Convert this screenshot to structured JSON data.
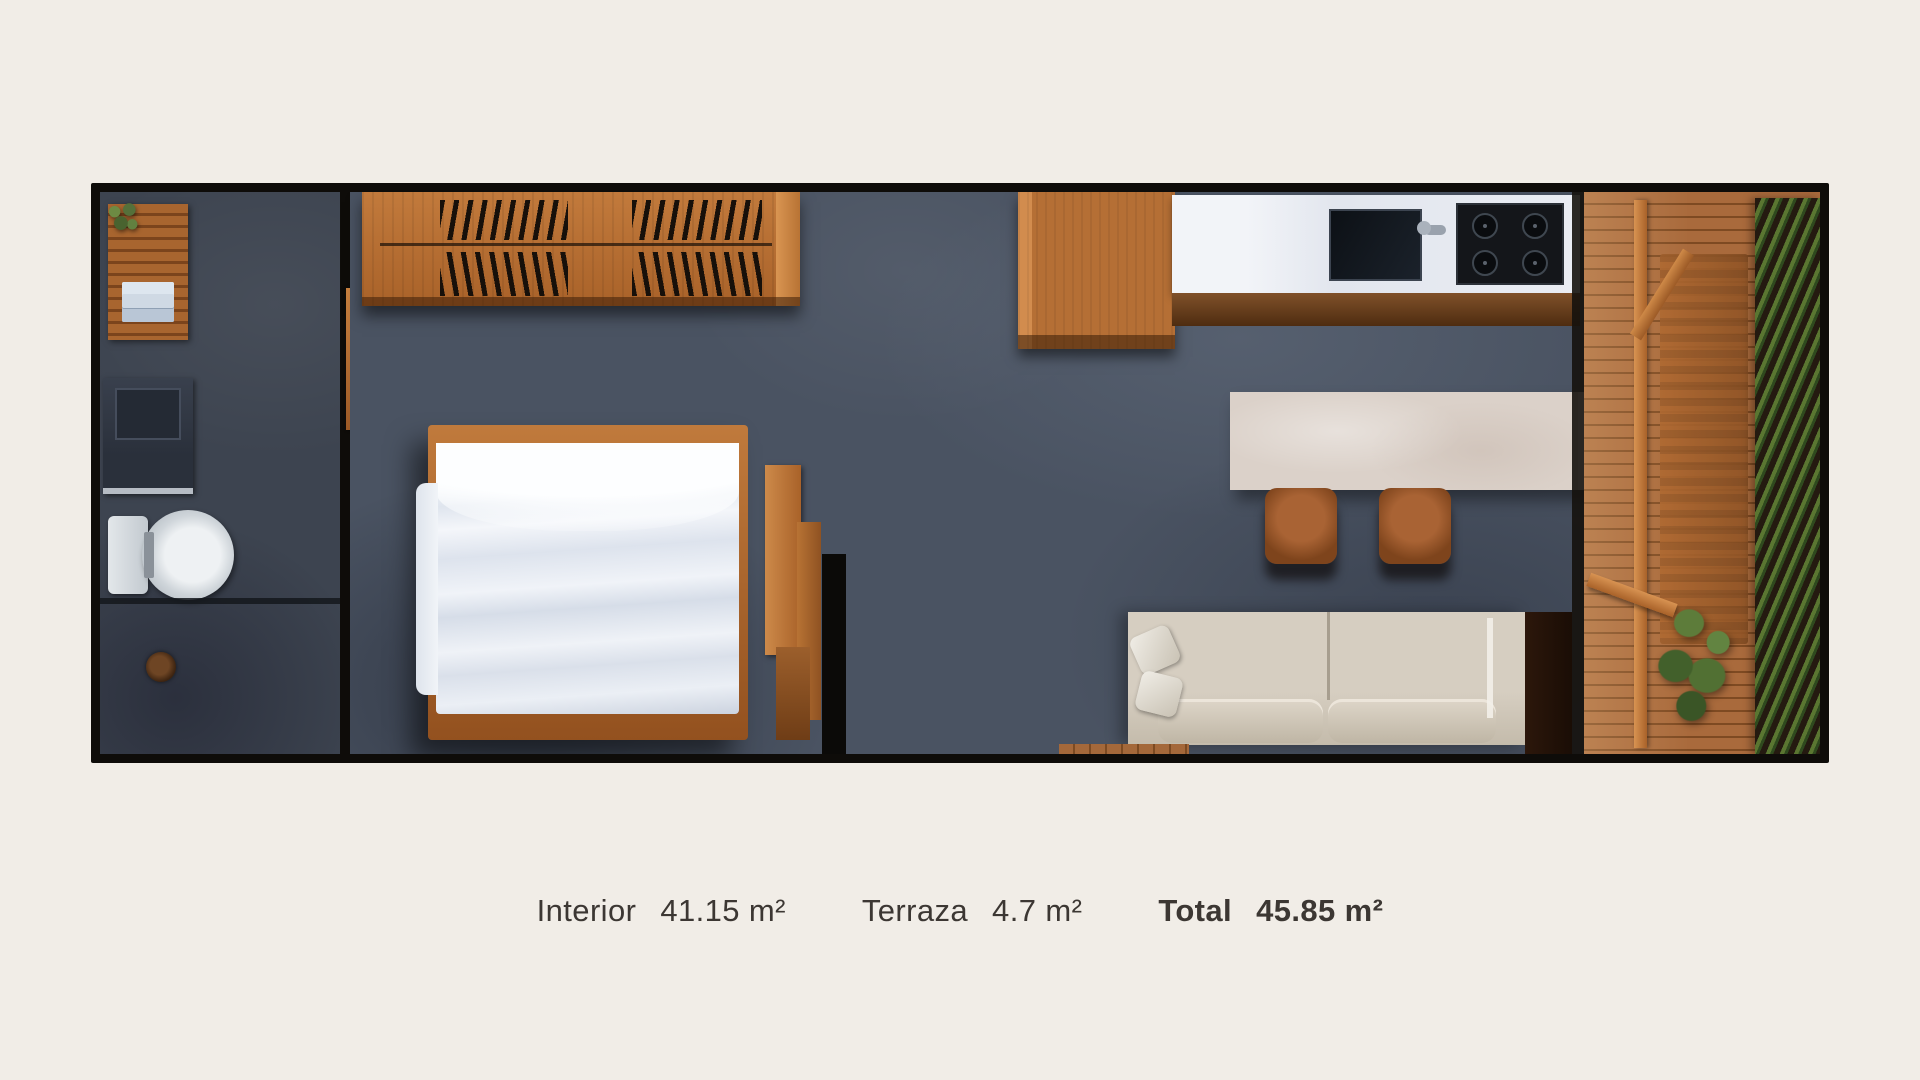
{
  "caption": {
    "items": [
      {
        "label": "Interior",
        "value": "41.15 m²",
        "bold": false
      },
      {
        "label": "Terraza",
        "value": "4.7 m²",
        "bold": false
      },
      {
        "label": "Total",
        "value": "45.85 m²",
        "bold": true
      }
    ]
  },
  "colors": {
    "background": "#f1ede7",
    "wall": "#0e0c09",
    "text": "#3c3733",
    "floor_concrete": "#4a5362",
    "floor_bath": "#3d4450",
    "wood": "#b56f35",
    "wood_dark": "#7c4a22",
    "deck": "#a4683a",
    "counter_white": "#e7eaf0",
    "island": "#dbd1c9",
    "sofa": "#cfc6b7",
    "appliance_black": "#101419",
    "plant_green": "#4d682f"
  }
}
